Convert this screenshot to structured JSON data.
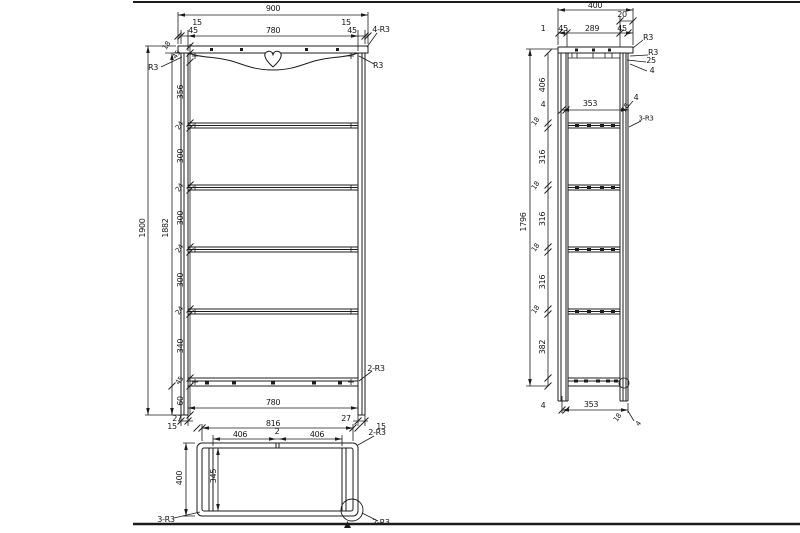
{
  "drawing": {
    "type": "technical-orthographic-drawing",
    "background": "#ffffff",
    "line_color": "#1c1c1c",
    "views": {
      "front": {
        "labels": [
          {
            "text": "900",
            "x": 273,
            "y": 9
          },
          {
            "text": "15",
            "x": 197,
            "y": 23
          },
          {
            "text": "15",
            "x": 346,
            "y": 23
          },
          {
            "text": "45",
            "x": 193,
            "y": 31
          },
          {
            "text": "780",
            "x": 273,
            "y": 31
          },
          {
            "text": "45",
            "x": 352,
            "y": 31
          },
          {
            "text": "4-R3",
            "x": 381,
            "y": 30
          },
          {
            "text": "18",
            "x": 167,
            "y": 46,
            "rot": -55,
            "size": 7
          },
          {
            "text": "45",
            "x": 177,
            "y": 55,
            "rot": -55,
            "size": 7
          },
          {
            "text": "R3",
            "x": 153,
            "y": 68
          },
          {
            "text": "R3",
            "x": 378,
            "y": 66
          },
          {
            "text": "1900",
            "x": 143,
            "y": 228,
            "rot": -90
          },
          {
            "text": "1882",
            "x": 166,
            "y": 228,
            "rot": -90
          },
          {
            "text": "356",
            "x": 181,
            "y": 92,
            "rot": -90
          },
          {
            "text": "24",
            "x": 180,
            "y": 126,
            "rot": -55,
            "size": 7
          },
          {
            "text": "300",
            "x": 181,
            "y": 156,
            "rot": -90
          },
          {
            "text": "24",
            "x": 180,
            "y": 188,
            "rot": -55,
            "size": 7
          },
          {
            "text": "300",
            "x": 181,
            "y": 218,
            "rot": -90
          },
          {
            "text": "24",
            "x": 180,
            "y": 249,
            "rot": -55,
            "size": 7
          },
          {
            "text": "300",
            "x": 181,
            "y": 280,
            "rot": -90
          },
          {
            "text": "24",
            "x": 180,
            "y": 311,
            "rot": -55,
            "size": 7
          },
          {
            "text": "340",
            "x": 181,
            "y": 346,
            "rot": -90
          },
          {
            "text": "45",
            "x": 180,
            "y": 381,
            "rot": -55,
            "size": 7
          },
          {
            "text": "60",
            "x": 181,
            "y": 401,
            "rot": -90
          },
          {
            "text": "2-R3",
            "x": 376,
            "y": 369
          },
          {
            "text": "780",
            "x": 273,
            "y": 403
          },
          {
            "text": "27",
            "x": 177,
            "y": 419
          },
          {
            "text": "27",
            "x": 346,
            "y": 419
          }
        ]
      },
      "bottom": {
        "labels": [
          {
            "text": "15",
            "x": 172,
            "y": 427
          },
          {
            "text": "816",
            "x": 273,
            "y": 424
          },
          {
            "text": "15",
            "x": 381,
            "y": 427
          },
          {
            "text": "2-R3",
            "x": 377,
            "y": 433
          },
          {
            "text": "406",
            "x": 240,
            "y": 435
          },
          {
            "text": "2",
            "x": 277,
            "y": 432
          },
          {
            "text": "406",
            "x": 317,
            "y": 435
          },
          {
            "text": "400",
            "x": 180,
            "y": 478,
            "rot": -90
          },
          {
            "text": "345",
            "x": 214,
            "y": 476,
            "rot": -90
          },
          {
            "text": "3-R3",
            "x": 166,
            "y": 520
          },
          {
            "text": "2-R3",
            "x": 381,
            "y": 523
          }
        ]
      },
      "side": {
        "labels": [
          {
            "text": "400",
            "x": 595,
            "y": 6
          },
          {
            "text": "20",
            "x": 622,
            "y": 15
          },
          {
            "text": "1",
            "x": 543,
            "y": 29
          },
          {
            "text": "45",
            "x": 563,
            "y": 29
          },
          {
            "text": "289",
            "x": 592,
            "y": 29
          },
          {
            "text": "45",
            "x": 622,
            "y": 29
          },
          {
            "text": "R3",
            "x": 648,
            "y": 38
          },
          {
            "text": "R3",
            "x": 653,
            "y": 53
          },
          {
            "text": "25",
            "x": 651,
            "y": 61
          },
          {
            "text": "4",
            "x": 652,
            "y": 71
          },
          {
            "text": "4",
            "x": 636,
            "y": 98
          },
          {
            "text": "18",
            "x": 626,
            "y": 108,
            "rot": -55,
            "size": 7
          },
          {
            "text": "3-R3",
            "x": 646,
            "y": 119,
            "size": 7
          },
          {
            "text": "406",
            "x": 543,
            "y": 85,
            "rot": -90
          },
          {
            "text": "4",
            "x": 543,
            "y": 105
          },
          {
            "text": "353",
            "x": 590,
            "y": 104
          },
          {
            "text": "1796",
            "x": 524,
            "y": 222,
            "rot": -90
          },
          {
            "text": "18",
            "x": 536,
            "y": 122,
            "rot": -55,
            "size": 7
          },
          {
            "text": "316",
            "x": 543,
            "y": 157,
            "rot": -90
          },
          {
            "text": "18",
            "x": 536,
            "y": 186,
            "rot": -55,
            "size": 7
          },
          {
            "text": "316",
            "x": 543,
            "y": 219,
            "rot": -90
          },
          {
            "text": "18",
            "x": 536,
            "y": 248,
            "rot": -55,
            "size": 7
          },
          {
            "text": "316",
            "x": 543,
            "y": 282,
            "rot": -90
          },
          {
            "text": "18",
            "x": 536,
            "y": 310,
            "rot": -55,
            "size": 7
          },
          {
            "text": "382",
            "x": 543,
            "y": 347,
            "rot": -90
          },
          {
            "text": "4",
            "x": 543,
            "y": 406
          },
          {
            "text": "353",
            "x": 591,
            "y": 405
          },
          {
            "text": "18",
            "x": 618,
            "y": 418,
            "rot": -55,
            "size": 7
          },
          {
            "text": "4",
            "x": 639,
            "y": 424,
            "rot": -55,
            "size": 7
          }
        ]
      }
    }
  }
}
